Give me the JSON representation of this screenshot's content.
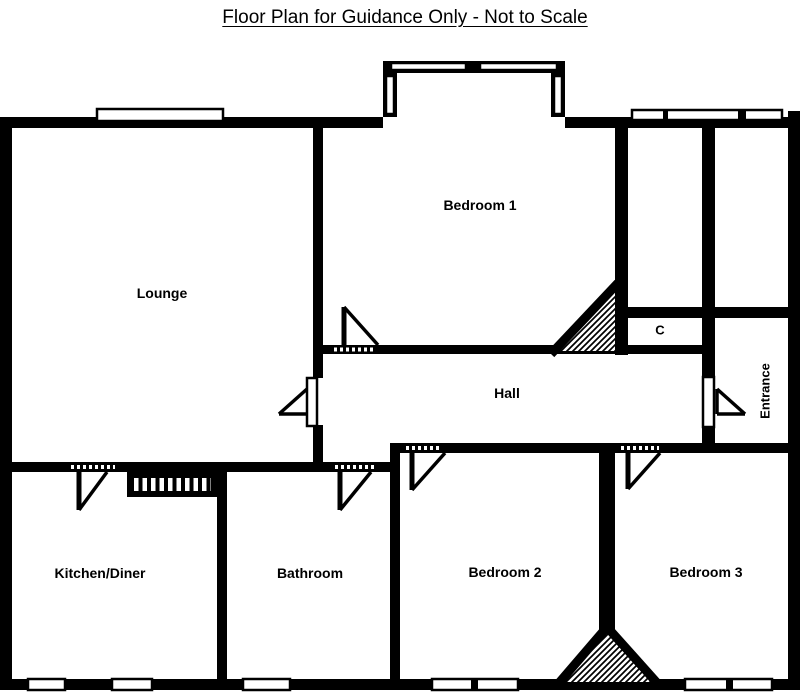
{
  "title": "Floor Plan for Guidance Only - Not to Scale",
  "colors": {
    "ink": "#000000",
    "paper": "#ffffff"
  },
  "rooms": [
    {
      "name": "lounge",
      "label": "Lounge"
    },
    {
      "name": "bedroom-1",
      "label": "Bedroom 1"
    },
    {
      "name": "cupboard",
      "label": "C"
    },
    {
      "name": "hall",
      "label": "Hall"
    },
    {
      "name": "entrance",
      "label": "Entrance",
      "orientation": "vertical"
    },
    {
      "name": "kitchen-diner",
      "label": "Kitchen/Diner"
    },
    {
      "name": "bathroom",
      "label": "Bathroom"
    },
    {
      "name": "bedroom-2",
      "label": "Bedroom 2"
    },
    {
      "name": "bedroom-3",
      "label": "Bedroom 3"
    }
  ]
}
